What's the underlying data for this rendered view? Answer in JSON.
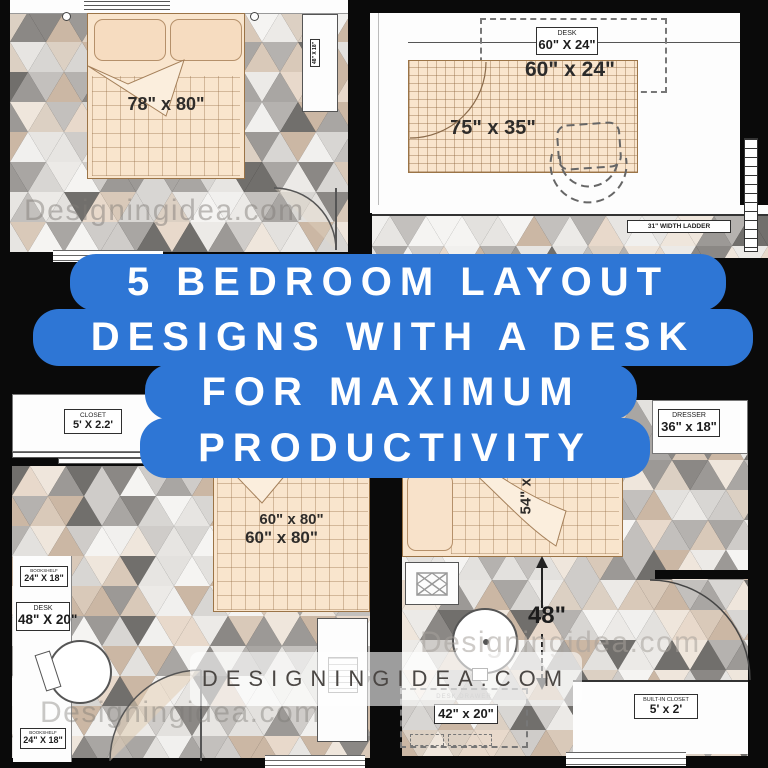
{
  "title": {
    "lines": [
      "5 BEDROOM LAYOUT",
      "DESIGNS WITH A DESK",
      "FOR MAXIMUM",
      "PRODUCTIVITY"
    ]
  },
  "banner": {
    "text": "DESIGNINGIDEA.COM"
  },
  "watermarks": {
    "top_left": "Designingidea.com",
    "bottom_left": "Designingidea.com",
    "bottom_right": "Designingidea.com"
  },
  "rooms": {
    "top_left": {
      "bed_size": "78\" x 80\"",
      "side_desk_size": "48\" X 18\""
    },
    "top_right": {
      "desk_label": "DESK",
      "desk_box_size": "60\" X 24\"",
      "desk_size": "60\" x 24\"",
      "bed_size": "75\" x 35\"",
      "ladder_label": "31\" WIDTH LADDER"
    },
    "bottom_left": {
      "closet_label": "CLOSET",
      "closet_size": "5' X 2.2'",
      "bookshelf_top_label": "BOOKSHELF",
      "bookshelf_top_size": "24\" X 18\"",
      "desk_label": "DESK",
      "desk_size": "48\" X 20\"",
      "bookshelf_bottom_label": "BOOKSHELF",
      "bookshelf_bottom_size": "24\" X 18\"",
      "bed_size_a": "60\" x 80\"",
      "bed_size_b": "60\" x 80\""
    },
    "bottom_right": {
      "dresser_label": "DRESSER",
      "dresser_size": "36\" x 18\"",
      "bed_size_partial": "54\" x",
      "clearance": "48\"",
      "desk_drawer_label": "DESK DRAWER",
      "desk_size": "42\" x 20\"",
      "closet_label": "BUILT-IN CLOSET",
      "closet_size": "5' x 2'"
    }
  },
  "colors": {
    "vars": {
      "accent": "#2e76d5",
      "bed": "#f9e5cd",
      "bed-line": "#9b7447",
      "banner-text": "#4b4744",
      "wall": "#0a0a0a"
    },
    "mosaic_palette": [
      "#eceae7",
      "#e3e1de",
      "#d8d6d3",
      "#cfccc9",
      "#c3c0bd",
      "#f1f0ee",
      "#b5b2af",
      "#9c9996",
      "#8b8885",
      "#d9c9b9",
      "#cbb7a4",
      "#e8d9cb",
      "#efe6dc",
      "#dcd0c3",
      "#f5f4f2",
      "#a9a6a3",
      "#716f6c",
      "#e7e5e2"
    ]
  }
}
